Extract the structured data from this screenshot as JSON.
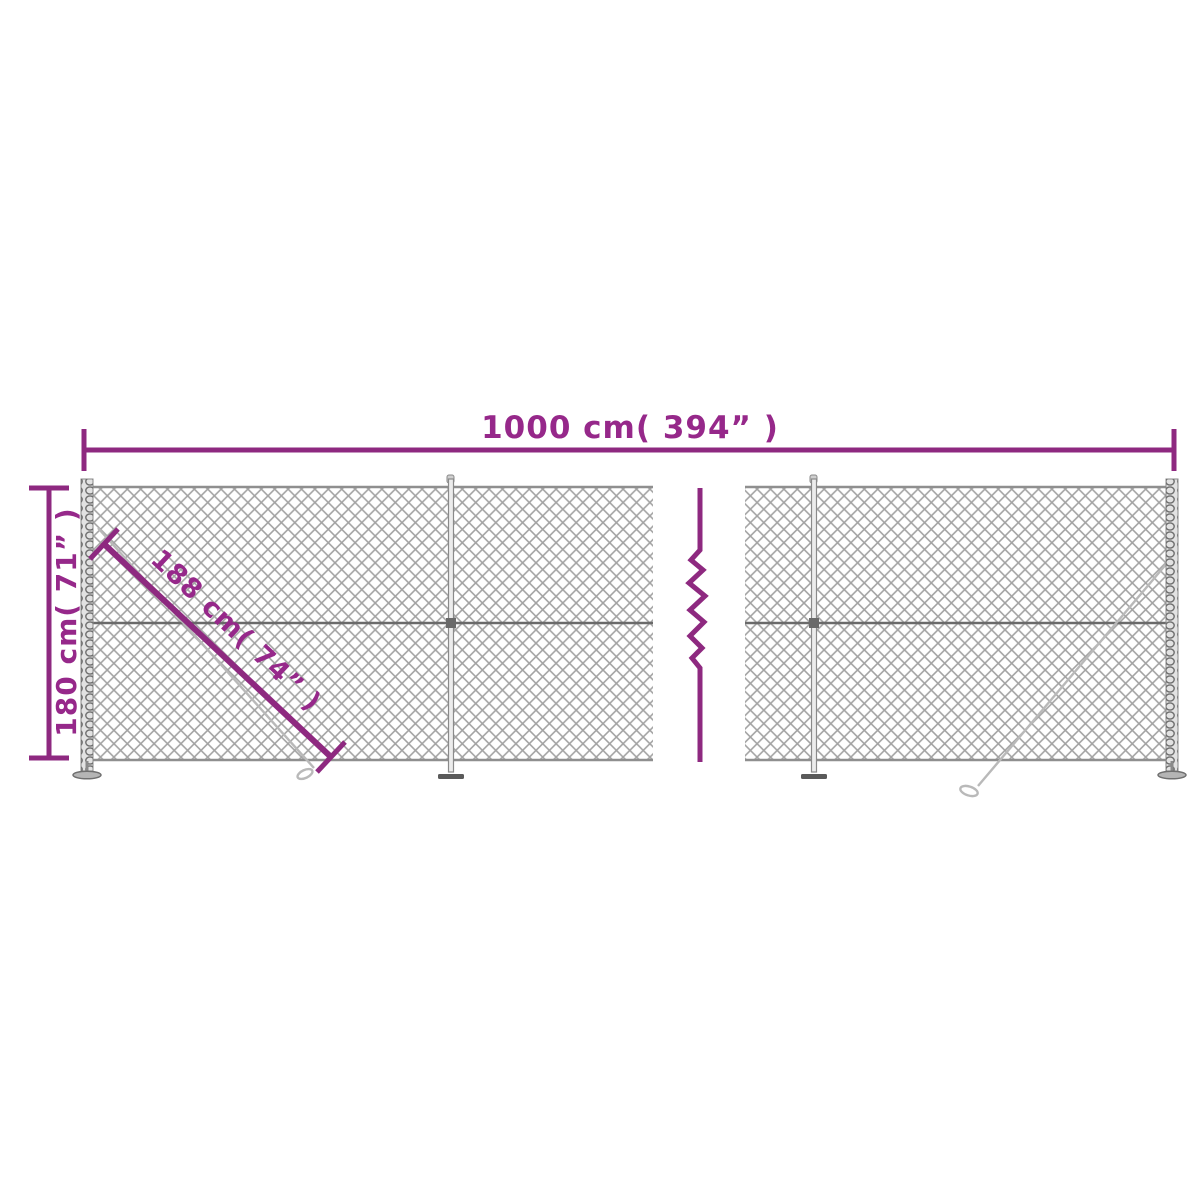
{
  "diagram": {
    "type": "fence-dimension-diagram",
    "subject": "chain-link fence with flange posts",
    "labels": {
      "width": "1000 cm( 394” )",
      "height": "180 cm( 71” )",
      "diagonal": "188 cm( 74” )"
    },
    "colors": {
      "dimension_line": "#8e2980",
      "dimension_text": "#96288a",
      "mesh_wire": "#a2a2a2",
      "mesh_edge": "#8f8f8f",
      "tension_wire": "#6a6a6a",
      "post": "#8a8a8a",
      "background": "#ffffff"
    }
  }
}
